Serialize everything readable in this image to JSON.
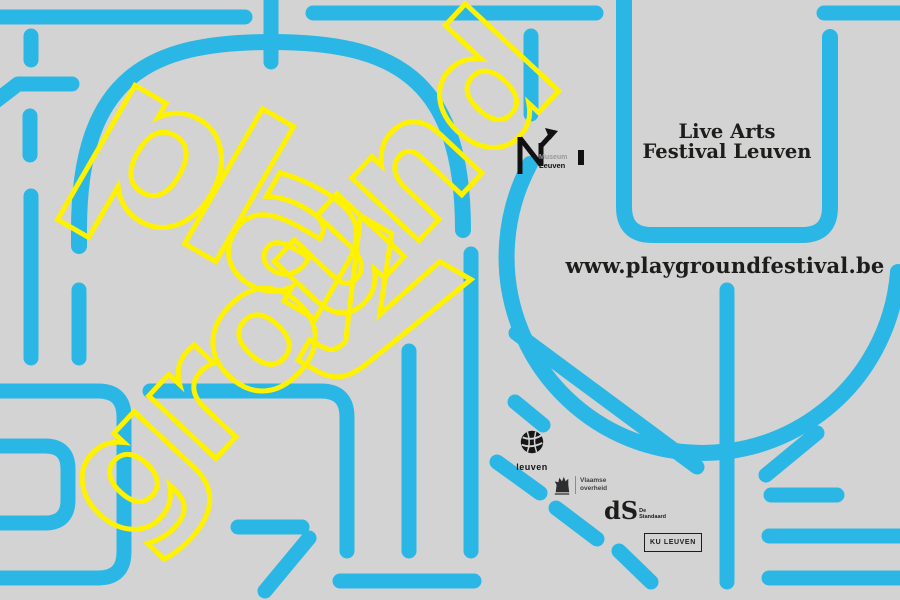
{
  "meta": {
    "title": "Playground Festival Leuven poster"
  },
  "colors": {
    "bg": "#d3d3d3",
    "blue": "#2bb7e5",
    "yellow": "#fff200",
    "ink": "#1d1d1b",
    "muted": "#9a9a9a"
  },
  "wordmark": {
    "word": "playground",
    "line1": "play",
    "line2": "ground"
  },
  "museum_logo": {
    "name": "M Museum Leuven",
    "text_top": "Museum",
    "text_bottom": "Leuven"
  },
  "festival": {
    "line1": "Live Arts",
    "line2": "Festival Leuven"
  },
  "website": {
    "url": "www.playgroundfestival.be"
  },
  "partners": {
    "leuven": {
      "label": "leuven"
    },
    "vlaamse_overheid": {
      "line1": "Vlaamse",
      "line2": "overheid"
    },
    "de_standaard": {
      "mark": "dS",
      "label_line1": "De",
      "label_line2": "Standaard"
    },
    "ku_leuven": {
      "label": "KU LEUVEN"
    }
  }
}
